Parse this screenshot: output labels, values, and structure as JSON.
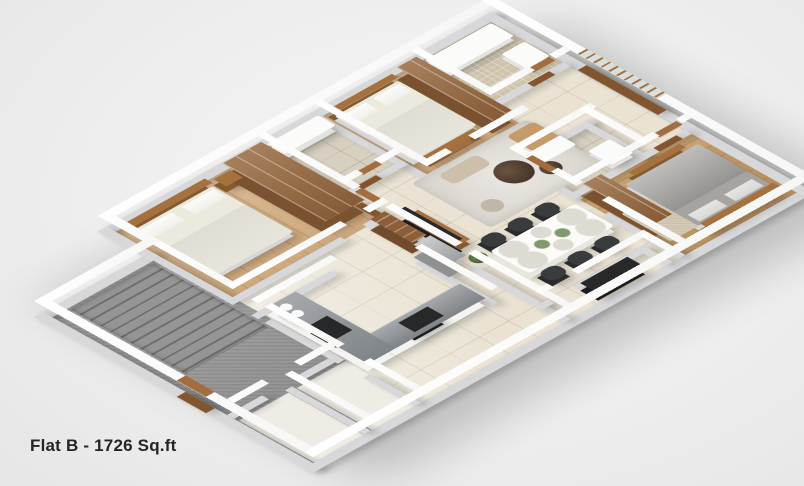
{
  "title": "Flat B - 1726 Sq.ft",
  "palette": {
    "background": "#eeeeee",
    "wall_top": "#ffffff",
    "wall_side": "#d8d8da",
    "marble_floor": "#eae3d4",
    "wood_floor": "#d8b184",
    "wood_floor_dark": "#c49a66",
    "stair_gray": "#8f8f8f",
    "furniture_wood": "#96663c",
    "counter_gray": "#878c90",
    "tv_black": "#27282a",
    "bedding_white": "#f1efe9",
    "bedding_gray": "#a5a4a1",
    "dining_chair": "#3a3b3d",
    "rug_gray": "#dcd8d1",
    "title_text": "#252525"
  },
  "scene": {
    "rooms": [
      {
        "name": "main-floor-base",
        "floor": "tile",
        "x": 170,
        "y": 0,
        "w": 590,
        "h": 480,
        "z": 0.1
      },
      {
        "name": "stair-wing-floor",
        "floor": "gray",
        "x": 0,
        "y": 70,
        "w": 170,
        "h": 290,
        "z": 0.2
      },
      {
        "name": "entry-corridor-floor",
        "floor": "gray",
        "x": 0,
        "y": 340,
        "w": 170,
        "h": 140,
        "z": 0.15
      },
      {
        "name": "entry-room-1-floor",
        "floor": "plain",
        "x": 2,
        "y": 362,
        "w": 78,
        "h": 118,
        "z": 0.5
      },
      {
        "name": "entry-room-2-floor",
        "floor": "plain",
        "x": 93,
        "y": 362,
        "w": 77,
        "h": 118,
        "z": 0.5
      },
      {
        "name": "bedroom-1-floor",
        "floor": "wood",
        "x": 170,
        "y": 0,
        "w": 230,
        "h": 190,
        "z": 0.5
      },
      {
        "name": "bathroom-1-floor",
        "floor": "stone",
        "x": 400,
        "y": 0,
        "w": 90,
        "h": 124,
        "z": 0.5
      },
      {
        "name": "bedroom-2-floor",
        "floor": "wood",
        "x": 490,
        "y": 0,
        "w": 150,
        "h": 164,
        "z": 0.5
      },
      {
        "name": "bathroom-2-floor",
        "floor": "mosaic",
        "x": 640,
        "y": 0,
        "w": 120,
        "h": 114,
        "z": 0.5
      },
      {
        "name": "bathroom-3-floor",
        "floor": "stone",
        "x": 580,
        "y": 220,
        "w": 110,
        "h": 90,
        "z": 0.5
      },
      {
        "name": "master-bedroom-floor",
        "floor": "wood-dark",
        "x": 580,
        "y": 310,
        "w": 180,
        "h": 170,
        "z": 0.5
      },
      {
        "name": "master-rug",
        "floor": "carpet",
        "x": 592,
        "y": 372,
        "w": 86,
        "h": 78,
        "z": 0.9
      },
      {
        "name": "living-room-rug",
        "floor": "rug",
        "x": 470,
        "y": 165,
        "w": 180,
        "h": 125,
        "z": 0.9
      }
    ],
    "walls": [
      {
        "name": "wall-ext-top-main",
        "x": 156,
        "y": -14,
        "w": 618,
        "h": 14
      },
      {
        "name": "wall-ext-top-wing",
        "x": -14,
        "y": 56,
        "w": 184,
        "h": 14
      },
      {
        "name": "wall-ext-left",
        "x": -14,
        "y": 56,
        "w": 14,
        "h": 438
      },
      {
        "name": "wall-ext-bottom",
        "x": -14,
        "y": 480,
        "w": 788,
        "h": 14
      },
      {
        "name": "wall-ext-right",
        "x": 760,
        "y": -14,
        "w": 14,
        "h": 508
      },
      {
        "name": "wall-ext-notch",
        "x": 156,
        "y": -14,
        "w": 14,
        "h": 84
      },
      {
        "name": "wall-entry-a",
        "x": 0,
        "y": 345,
        "w": 55,
        "h": 11
      },
      {
        "name": "wall-entry-b",
        "x": 105,
        "y": 345,
        "w": 65,
        "h": 11
      },
      {
        "name": "wall-entry-split",
        "x": 80,
        "y": 356,
        "w": 11,
        "h": 124
      },
      {
        "name": "wall-wing-main-a",
        "x": 159,
        "y": 70,
        "w": 11,
        "h": 115
      },
      {
        "name": "wall-wing-main-b",
        "x": 159,
        "y": 245,
        "w": 11,
        "h": 115
      },
      {
        "name": "wall-wing-main-c",
        "x": 159,
        "y": 400,
        "w": 11,
        "h": 80
      },
      {
        "name": "wall-bedroom1-bottom-a",
        "x": 159,
        "y": 184,
        "w": 180,
        "h": 11
      },
      {
        "name": "wall-bedroom1-bottom-b",
        "x": 374,
        "y": 184,
        "w": 31,
        "h": 11
      },
      {
        "name": "wall-bedroom1-right",
        "x": 394,
        "y": 0,
        "w": 11,
        "h": 150
      },
      {
        "name": "wall-tv",
        "x": 394,
        "y": 200,
        "w": 11,
        "h": 110
      },
      {
        "name": "wall-dining-left",
        "x": 394,
        "y": 330,
        "w": 11,
        "h": 150
      },
      {
        "name": "wall-bath1-right",
        "x": 484,
        "y": 0,
        "w": 11,
        "h": 170
      },
      {
        "name": "wall-bath1-bottom-a",
        "x": 394,
        "y": 124,
        "w": 30,
        "h": 11
      },
      {
        "name": "wall-bath1-bottom-b",
        "x": 452,
        "y": 124,
        "w": 43,
        "h": 11
      },
      {
        "name": "wall-bedroom2-bottom-a",
        "x": 484,
        "y": 164,
        "w": 40,
        "h": 11
      },
      {
        "name": "wall-bedroom2-bottom-b",
        "x": 560,
        "y": 164,
        "w": 85,
        "h": 11
      },
      {
        "name": "wall-bath2-left",
        "x": 634,
        "y": 0,
        "w": 11,
        "h": 120
      },
      {
        "name": "wall-bath2-bottom-a",
        "x": 634,
        "y": 114,
        "w": 70,
        "h": 11
      },
      {
        "name": "wall-bath2-bottom-b",
        "x": 737,
        "y": 114,
        "w": 23,
        "h": 11
      },
      {
        "name": "wall-kitchen-right",
        "x": 360,
        "y": 280,
        "w": 11,
        "h": 120
      },
      {
        "name": "wall-kitchen-top",
        "x": 159,
        "y": 224,
        "w": 125,
        "h": 11
      },
      {
        "name": "wall-dining-right-a",
        "x": 574,
        "y": 220,
        "w": 11,
        "h": 20
      },
      {
        "name": "wall-dining-right-b",
        "x": 574,
        "y": 280,
        "w": 11,
        "h": 40
      },
      {
        "name": "wall-dining-right-c",
        "x": 574,
        "y": 360,
        "w": 11,
        "h": 120
      },
      {
        "name": "wall-bath3-top",
        "x": 574,
        "y": 214,
        "w": 127,
        "h": 11
      },
      {
        "name": "wall-bath3-right",
        "x": 684,
        "y": 214,
        "w": 11,
        "h": 101
      },
      {
        "name": "wall-bath3-bottom",
        "x": 574,
        "y": 304,
        "w": 121,
        "h": 11
      },
      {
        "name": "wall-master-top-a",
        "x": 684,
        "y": 304,
        "w": 26,
        "h": 11
      },
      {
        "name": "wall-master-top-b",
        "x": 746,
        "y": 304,
        "w": 14,
        "h": 11
      },
      {
        "name": "wall-utility-top-a",
        "x": 394,
        "y": 434,
        "w": 20,
        "h": 11
      },
      {
        "name": "wall-utility-top-b",
        "x": 452,
        "y": 434,
        "w": 113,
        "h": 11
      },
      {
        "name": "wall-utility-right",
        "x": 554,
        "y": 440,
        "w": 11,
        "h": 40
      }
    ],
    "furniture": [
      {
        "name": "staircase",
        "kind": "stairs",
        "x": 24,
        "y": 76,
        "w": 130,
        "h": 180,
        "z": 2
      },
      {
        "name": "main-entry-door",
        "kind": "door",
        "x": -14,
        "y": 280,
        "w": 14,
        "h": 46,
        "z": 20.5
      },
      {
        "name": "bed-1-headboard",
        "kind": "wood",
        "x": 182,
        "y": 6,
        "w": 122,
        "h": 12,
        "z": 10
      },
      {
        "name": "bed-1",
        "kind": "bed",
        "x": 182,
        "y": 18,
        "w": 122,
        "h": 128,
        "z": 6
      },
      {
        "name": "bed-1-nightstand",
        "kind": "wood",
        "x": 312,
        "y": 12,
        "w": 26,
        "h": 20,
        "z": 8
      },
      {
        "name": "bedroom-1-wardrobe",
        "kind": "wardrobe",
        "x": 332,
        "y": 6,
        "w": 60,
        "h": 162,
        "z": 16
      },
      {
        "name": "bedroom-1-door",
        "kind": "door",
        "x": 394,
        "y": 152,
        "w": 11,
        "h": 40,
        "z": 18
      },
      {
        "name": "bathroom-1-vanity",
        "kind": "white",
        "x": 404,
        "y": 4,
        "w": 80,
        "h": 28,
        "z": 8
      },
      {
        "name": "bathroom-1-door",
        "kind": "door",
        "x": 424,
        "y": 125,
        "w": 30,
        "h": 10,
        "z": 18
      },
      {
        "name": "bed-2-headboard",
        "kind": "wood",
        "x": 498,
        "y": 6,
        "w": 100,
        "h": 10,
        "z": 10
      },
      {
        "name": "bed-2",
        "kind": "bed",
        "x": 498,
        "y": 16,
        "w": 100,
        "h": 124,
        "z": 6
      },
      {
        "name": "bed-2-foot-bench",
        "kind": "wood",
        "x": 508,
        "y": 144,
        "w": 80,
        "h": 12,
        "z": 8
      },
      {
        "name": "bedroom-2-wardrobe",
        "kind": "wardrobe",
        "x": 604,
        "y": 8,
        "w": 30,
        "h": 150,
        "z": 16
      },
      {
        "name": "bedroom-2-door",
        "kind": "door",
        "x": 522,
        "y": 165,
        "w": 36,
        "h": 10,
        "z": 18
      },
      {
        "name": "bathroom-2-tub",
        "kind": "white",
        "x": 648,
        "y": 8,
        "w": 104,
        "h": 36,
        "z": 6
      },
      {
        "name": "bathroom-2-toilet",
        "kind": "white",
        "x": 716,
        "y": 60,
        "w": 36,
        "h": 40,
        "z": 6
      },
      {
        "name": "bathroom-2-door",
        "kind": "door",
        "x": 702,
        "y": 115,
        "w": 34,
        "h": 10,
        "z": 18
      },
      {
        "name": "tv-panel",
        "kind": "dark",
        "x": 405,
        "y": 210,
        "w": 10,
        "h": 90,
        "z": 16
      },
      {
        "name": "tv-console",
        "kind": "wood",
        "x": 415,
        "y": 214,
        "w": 16,
        "h": 82,
        "z": 7
      },
      {
        "name": "living-plant",
        "kind": "plant",
        "x": 406,
        "y": 312,
        "w": 22,
        "h": 22,
        "z": 2
      },
      {
        "name": "crockery-cabinet",
        "kind": "crockery",
        "x": 372,
        "y": 198,
        "w": 22,
        "h": 66,
        "z": 14
      },
      {
        "name": "refrigerator",
        "kind": "fridge",
        "x": 368,
        "y": 270,
        "w": 26,
        "h": 56,
        "z": 16
      },
      {
        "name": "coffee-table-large",
        "kind": "round-dark",
        "x": 538,
        "y": 212,
        "w": 46,
        "h": 46,
        "z": 6
      },
      {
        "name": "coffee-table-small",
        "kind": "round-dark",
        "x": 584,
        "y": 244,
        "w": 26,
        "h": 26,
        "z": 5
      },
      {
        "name": "lounge-chair",
        "kind": "lounge",
        "x": 606,
        "y": 178,
        "w": 42,
        "h": 50,
        "z": 5
      },
      {
        "name": "chaise-cushion",
        "kind": "chaise",
        "x": 498,
        "y": 178,
        "w": 60,
        "h": 26,
        "z": 4
      },
      {
        "name": "living-pouf",
        "kind": "pouf",
        "x": 486,
        "y": 250,
        "w": 26,
        "h": 26,
        "z": 4
      },
      {
        "name": "balcony-french-doors",
        "kind": "glassdoor",
        "x": 760,
        "y": 136,
        "w": 14,
        "h": 126,
        "z": 20.5
      },
      {
        "name": "kitchen-counter-left",
        "kind": "counter",
        "x": 172,
        "y": 236,
        "w": 44,
        "h": 158,
        "z": 10
      },
      {
        "name": "kitchen-counter-bottom",
        "kind": "counter",
        "x": 216,
        "y": 354,
        "w": 140,
        "h": 40,
        "z": 10
      },
      {
        "name": "kitchen-sink",
        "kind": "dark",
        "x": 180,
        "y": 296,
        "w": 26,
        "h": 40,
        "z": 11
      },
      {
        "name": "kitchen-hob",
        "kind": "dark",
        "x": 252,
        "y": 362,
        "w": 46,
        "h": 26,
        "z": 11
      },
      {
        "name": "kitchen-canister-1",
        "kind": "white-round",
        "x": 178,
        "y": 246,
        "w": 14,
        "h": 14,
        "z": 12
      },
      {
        "name": "kitchen-canister-2",
        "kind": "white-round",
        "x": 178,
        "y": 264,
        "w": 14,
        "h": 14,
        "z": 12
      },
      {
        "name": "dining-table",
        "kind": "table",
        "x": 428,
        "y": 330,
        "w": 134,
        "h": 62,
        "z": 8
      },
      {
        "name": "dining-chair-1",
        "kind": "chair",
        "x": 436,
        "y": 302,
        "w": 28,
        "h": 24,
        "z": 6
      },
      {
        "name": "dining-chair-2",
        "kind": "chair",
        "x": 478,
        "y": 302,
        "w": 28,
        "h": 24,
        "z": 6
      },
      {
        "name": "dining-chair-3",
        "kind": "chair",
        "x": 520,
        "y": 302,
        "w": 28,
        "h": 24,
        "z": 6
      },
      {
        "name": "dining-chair-4",
        "kind": "chair",
        "x": 436,
        "y": 396,
        "w": 28,
        "h": 24,
        "z": 6
      },
      {
        "name": "dining-chair-5",
        "kind": "chair",
        "x": 478,
        "y": 396,
        "w": 28,
        "h": 24,
        "z": 6
      },
      {
        "name": "dining-chair-6",
        "kind": "chair",
        "x": 520,
        "y": 396,
        "w": 28,
        "h": 24,
        "z": 6
      },
      {
        "name": "bathroom-3-vanity",
        "kind": "white",
        "x": 588,
        "y": 222,
        "w": 58,
        "h": 26,
        "z": 8
      },
      {
        "name": "bathroom-3-toilet",
        "kind": "white",
        "x": 648,
        "y": 264,
        "w": 34,
        "h": 38,
        "z": 6
      },
      {
        "name": "bathroom-3-door",
        "kind": "door",
        "x": 575,
        "y": 240,
        "w": 10,
        "h": 38,
        "z": 18
      },
      {
        "name": "master-door",
        "kind": "door",
        "x": 710,
        "y": 305,
        "w": 36,
        "h": 10,
        "z": 18
      },
      {
        "name": "master-wardrobe",
        "kind": "wardrobe",
        "x": 586,
        "y": 318,
        "w": 28,
        "h": 112,
        "z": 16
      },
      {
        "name": "master-bed",
        "kind": "bed-gray",
        "x": 630,
        "y": 340,
        "w": 115,
        "h": 116,
        "z": 6
      },
      {
        "name": "master-bed-headboard",
        "kind": "wood",
        "x": 630,
        "y": 458,
        "w": 115,
        "h": 14,
        "z": 10
      },
      {
        "name": "master-foot-bench",
        "kind": "wood",
        "x": 648,
        "y": 328,
        "w": 80,
        "h": 10,
        "z": 8
      },
      {
        "name": "utility-wash-unit",
        "kind": "dark",
        "x": 452,
        "y": 448,
        "w": 74,
        "h": 28,
        "z": 10
      }
    ]
  }
}
